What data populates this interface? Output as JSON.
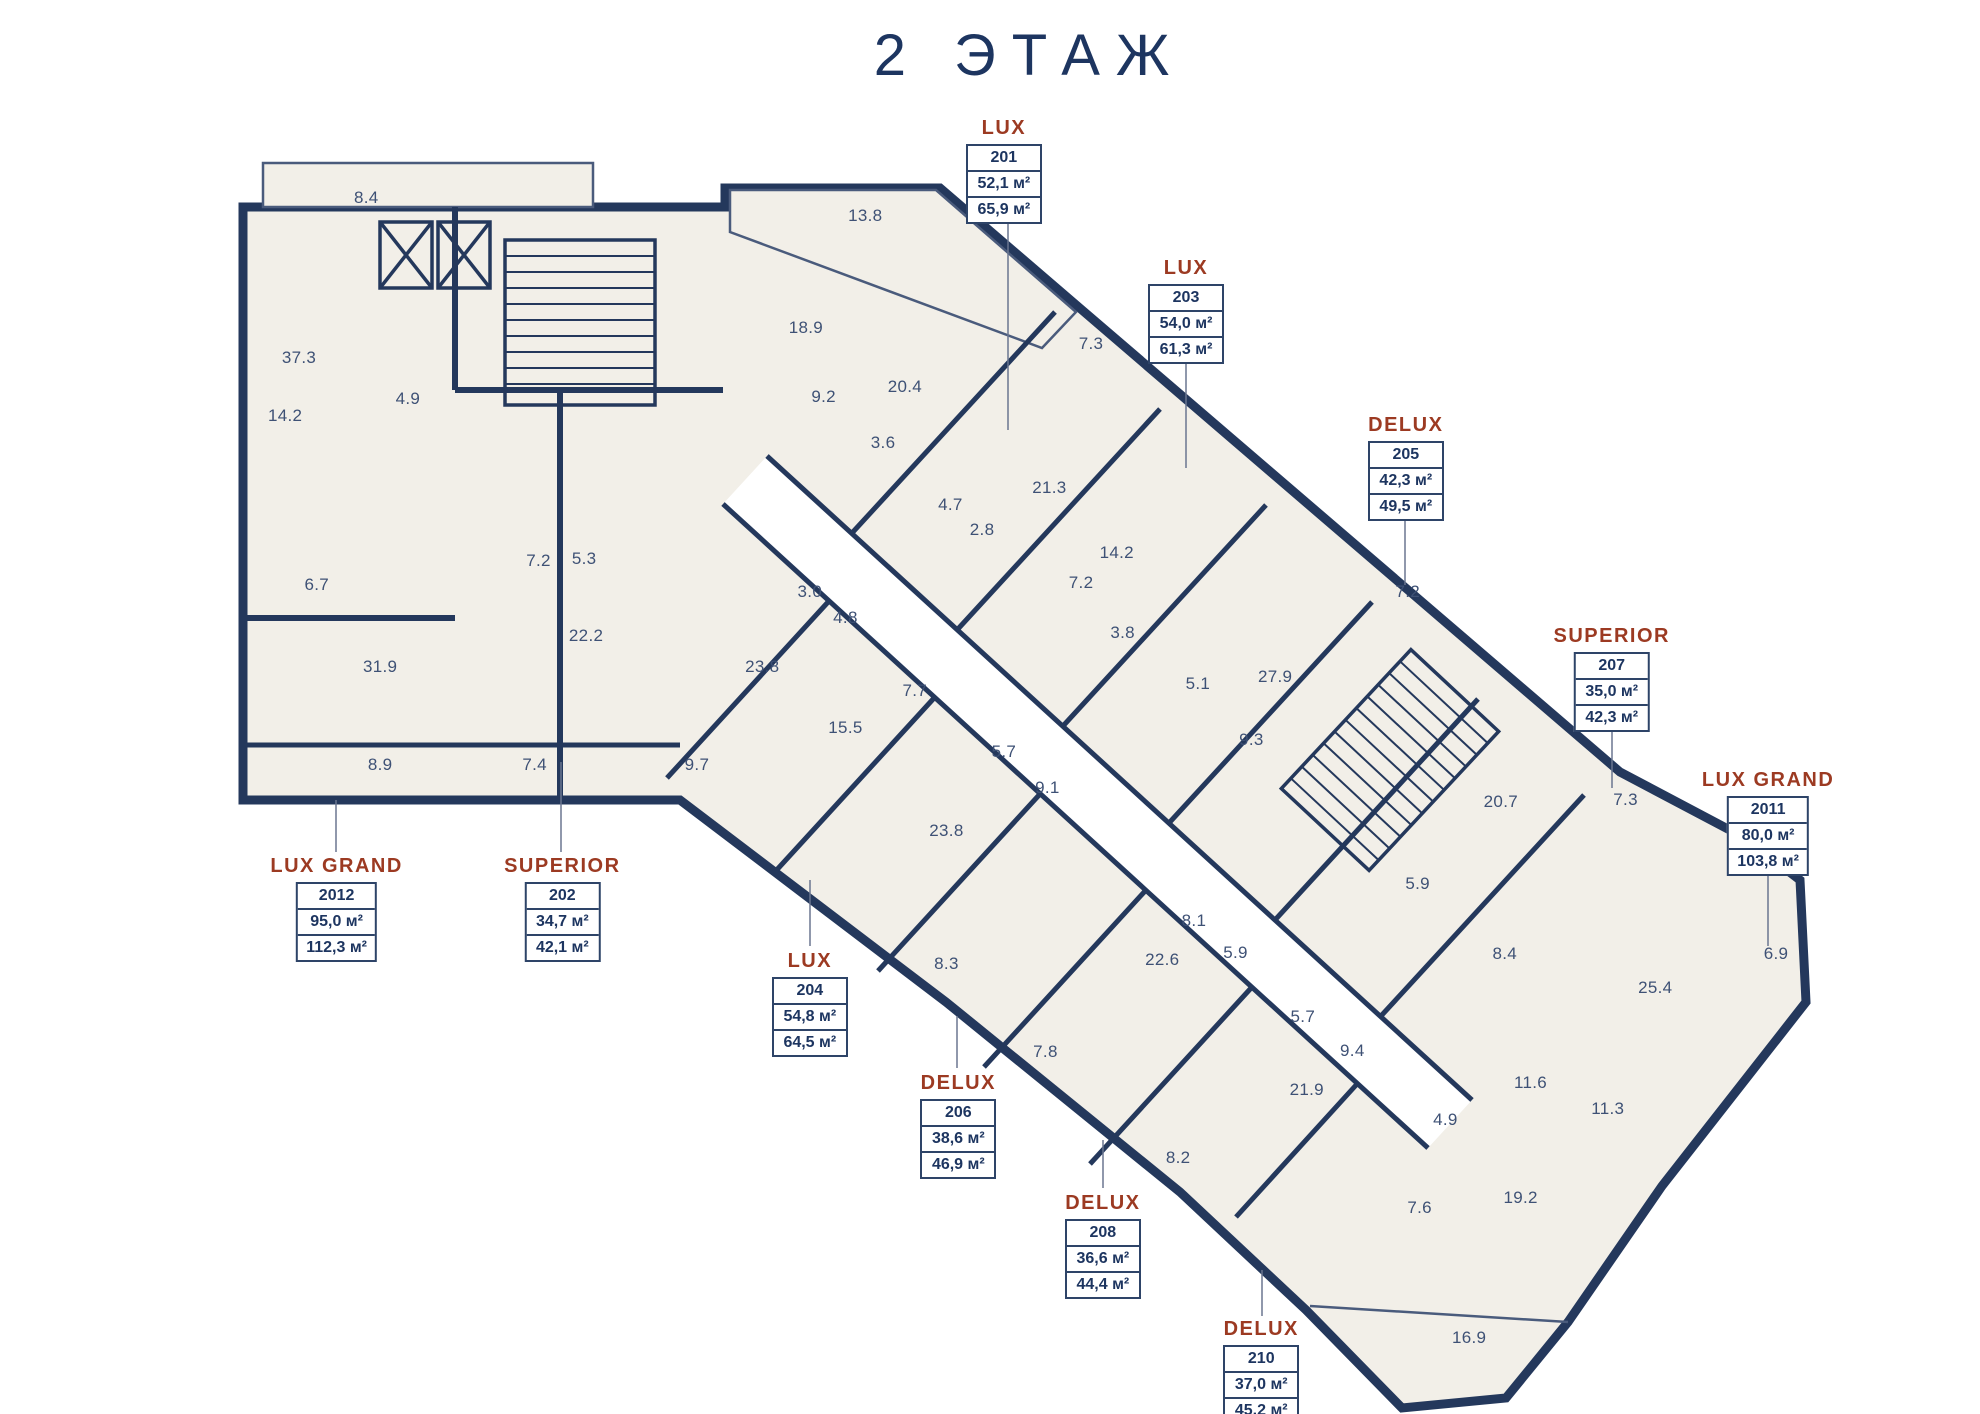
{
  "title": "2 ЭТАЖ",
  "colors": {
    "wall": "#24385c",
    "floor": "#f2efe8",
    "accent": "#9c3a22",
    "roomtext": "#3e5175"
  },
  "apartments": [
    {
      "type": "LUX",
      "unit": "201",
      "area_living": "52,1 м²",
      "area_total": "65,9 м²",
      "x": 50.7,
      "y": 8.3
    },
    {
      "type": "LUX",
      "unit": "203",
      "area_living": "54,0 м²",
      "area_total": "61,3 м²",
      "x": 59.9,
      "y": 18.2
    },
    {
      "type": "DELUX",
      "unit": "205",
      "area_living": "42,3 м²",
      "area_total": "49,5 м²",
      "x": 71.0,
      "y": 29.3
    },
    {
      "type": "SUPERIOR",
      "unit": "207",
      "area_living": "35,0 м²",
      "area_total": "42,3 м²",
      "x": 81.4,
      "y": 44.2
    },
    {
      "type": "LUX GRAND",
      "unit": "2011",
      "area_living": "80,0 м²",
      "area_total": "103,8 м²",
      "x": 89.3,
      "y": 54.4
    },
    {
      "type": "LUX GRAND",
      "unit": "2012",
      "area_living": "95,0 м²",
      "area_total": "112,3 м²",
      "x": 17.0,
      "y": 60.5
    },
    {
      "type": "SUPERIOR",
      "unit": "202",
      "area_living": "34,7 м²",
      "area_total": "42,1 м²",
      "x": 28.4,
      "y": 60.5
    },
    {
      "type": "LUX",
      "unit": "204",
      "area_living": "54,8 м²",
      "area_total": "64,5 м²",
      "x": 40.9,
      "y": 67.2
    },
    {
      "type": "DELUX",
      "unit": "206",
      "area_living": "38,6 м²",
      "area_total": "46,9 м²",
      "x": 48.4,
      "y": 75.8
    },
    {
      "type": "DELUX",
      "unit": "208",
      "area_living": "36,6 м²",
      "area_total": "44,4 м²",
      "x": 55.7,
      "y": 84.3
    },
    {
      "type": "DELUX",
      "unit": "210",
      "area_living": "37,0 м²",
      "area_total": "45,2 м²",
      "x": 63.7,
      "y": 93.2
    }
  ],
  "rooms": [
    {
      "label": "8.4",
      "x": 18.5,
      "y": 14.0
    },
    {
      "label": "37.3",
      "x": 15.1,
      "y": 25.3
    },
    {
      "label": "14.2",
      "x": 14.4,
      "y": 29.4
    },
    {
      "label": "4.9",
      "x": 20.6,
      "y": 28.2
    },
    {
      "label": "6.7",
      "x": 16.0,
      "y": 41.4
    },
    {
      "label": "31.9",
      "x": 19.2,
      "y": 47.2
    },
    {
      "label": "7.2",
      "x": 27.2,
      "y": 39.7
    },
    {
      "label": "5.3",
      "x": 29.5,
      "y": 39.5
    },
    {
      "label": "22.2",
      "x": 29.6,
      "y": 45.0
    },
    {
      "label": "8.9",
      "x": 19.2,
      "y": 54.1
    },
    {
      "label": "7.4",
      "x": 27.0,
      "y": 54.1
    },
    {
      "label": "9.7",
      "x": 35.2,
      "y": 54.1
    },
    {
      "label": "23.8",
      "x": 38.5,
      "y": 47.2
    },
    {
      "label": "13.8",
      "x": 43.7,
      "y": 15.3
    },
    {
      "label": "18.9",
      "x": 40.7,
      "y": 23.2
    },
    {
      "label": "9.2",
      "x": 41.6,
      "y": 28.1
    },
    {
      "label": "20.4",
      "x": 45.7,
      "y": 27.4
    },
    {
      "label": "3.6",
      "x": 44.6,
      "y": 31.3
    },
    {
      "label": "7.3",
      "x": 55.1,
      "y": 24.3
    },
    {
      "label": "4.7",
      "x": 48.0,
      "y": 35.7
    },
    {
      "label": "2.8",
      "x": 49.6,
      "y": 37.5
    },
    {
      "label": "21.3",
      "x": 53.0,
      "y": 34.5
    },
    {
      "label": "14.2",
      "x": 56.4,
      "y": 39.1
    },
    {
      "label": "7.2",
      "x": 54.6,
      "y": 41.2
    },
    {
      "label": "3.0",
      "x": 40.9,
      "y": 41.9
    },
    {
      "label": "4.8",
      "x": 42.7,
      "y": 43.7
    },
    {
      "label": "3.8",
      "x": 56.7,
      "y": 44.8
    },
    {
      "label": "5.1",
      "x": 60.5,
      "y": 48.4
    },
    {
      "label": "9.3",
      "x": 63.2,
      "y": 52.3
    },
    {
      "label": "27.9",
      "x": 64.4,
      "y": 47.9
    },
    {
      "label": "7.2",
      "x": 71.1,
      "y": 41.9
    },
    {
      "label": "7.7",
      "x": 46.2,
      "y": 48.9
    },
    {
      "label": "15.5",
      "x": 42.7,
      "y": 51.5
    },
    {
      "label": "5.7",
      "x": 50.7,
      "y": 53.2
    },
    {
      "label": "9.1",
      "x": 52.9,
      "y": 55.7
    },
    {
      "label": "23.8",
      "x": 47.8,
      "y": 58.8
    },
    {
      "label": "8.3",
      "x": 47.8,
      "y": 68.2
    },
    {
      "label": "7.8",
      "x": 52.8,
      "y": 74.4
    },
    {
      "label": "20.7",
      "x": 75.8,
      "y": 56.7
    },
    {
      "label": "7.3",
      "x": 82.1,
      "y": 56.6
    },
    {
      "label": "5.9",
      "x": 71.6,
      "y": 62.5
    },
    {
      "label": "8.4",
      "x": 76.0,
      "y": 67.5
    },
    {
      "label": "25.4",
      "x": 83.6,
      "y": 69.9
    },
    {
      "label": "6.9",
      "x": 89.7,
      "y": 67.5
    },
    {
      "label": "8.1",
      "x": 60.3,
      "y": 65.1
    },
    {
      "label": "5.9",
      "x": 62.4,
      "y": 67.4
    },
    {
      "label": "22.6",
      "x": 58.7,
      "y": 67.9
    },
    {
      "label": "5.7",
      "x": 65.8,
      "y": 71.9
    },
    {
      "label": "9.4",
      "x": 68.3,
      "y": 74.3
    },
    {
      "label": "21.9",
      "x": 66.0,
      "y": 77.1
    },
    {
      "label": "8.2",
      "x": 59.5,
      "y": 81.9
    },
    {
      "label": "4.9",
      "x": 73.0,
      "y": 79.2
    },
    {
      "label": "11.6",
      "x": 77.3,
      "y": 76.6
    },
    {
      "label": "11.3",
      "x": 81.2,
      "y": 78.4
    },
    {
      "label": "7.6",
      "x": 71.7,
      "y": 85.4
    },
    {
      "label": "19.2",
      "x": 76.8,
      "y": 84.7
    },
    {
      "label": "16.9",
      "x": 74.2,
      "y": 94.6
    }
  ]
}
